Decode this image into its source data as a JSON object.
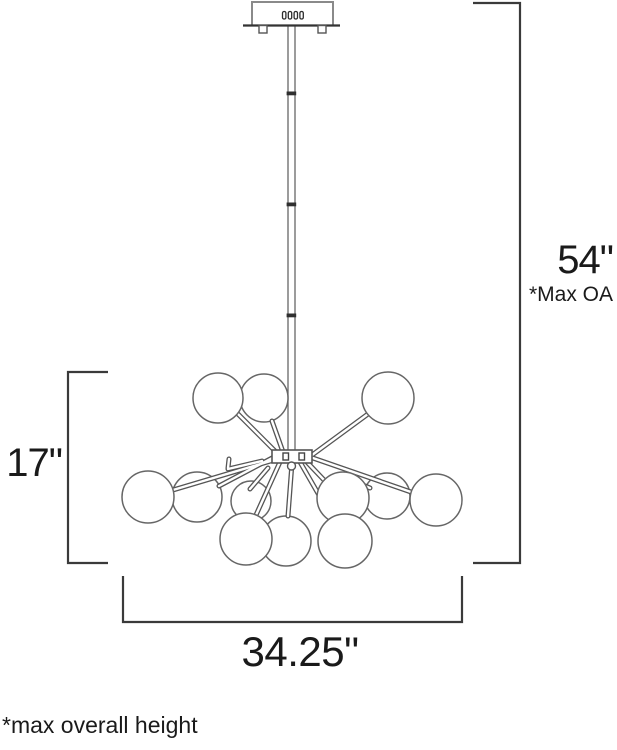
{
  "page": {
    "background": "#ffffff"
  },
  "annotations": {
    "overall_height": {
      "value": "54\"",
      "note": "*Max OA"
    },
    "fixture_height": {
      "value": "17\""
    },
    "fixture_width": {
      "value": "34.25\""
    },
    "footnote": "*max overall height"
  },
  "figure": {
    "name": "chandelier-dimension-drawing",
    "globe_count": 12,
    "colors": {
      "dimension_line": "#3a3a3a",
      "drawing_line": "#5f5f5f",
      "canopy_line": "#8a8a8a",
      "text": "#1a1a1a",
      "background": "#ffffff"
    }
  }
}
